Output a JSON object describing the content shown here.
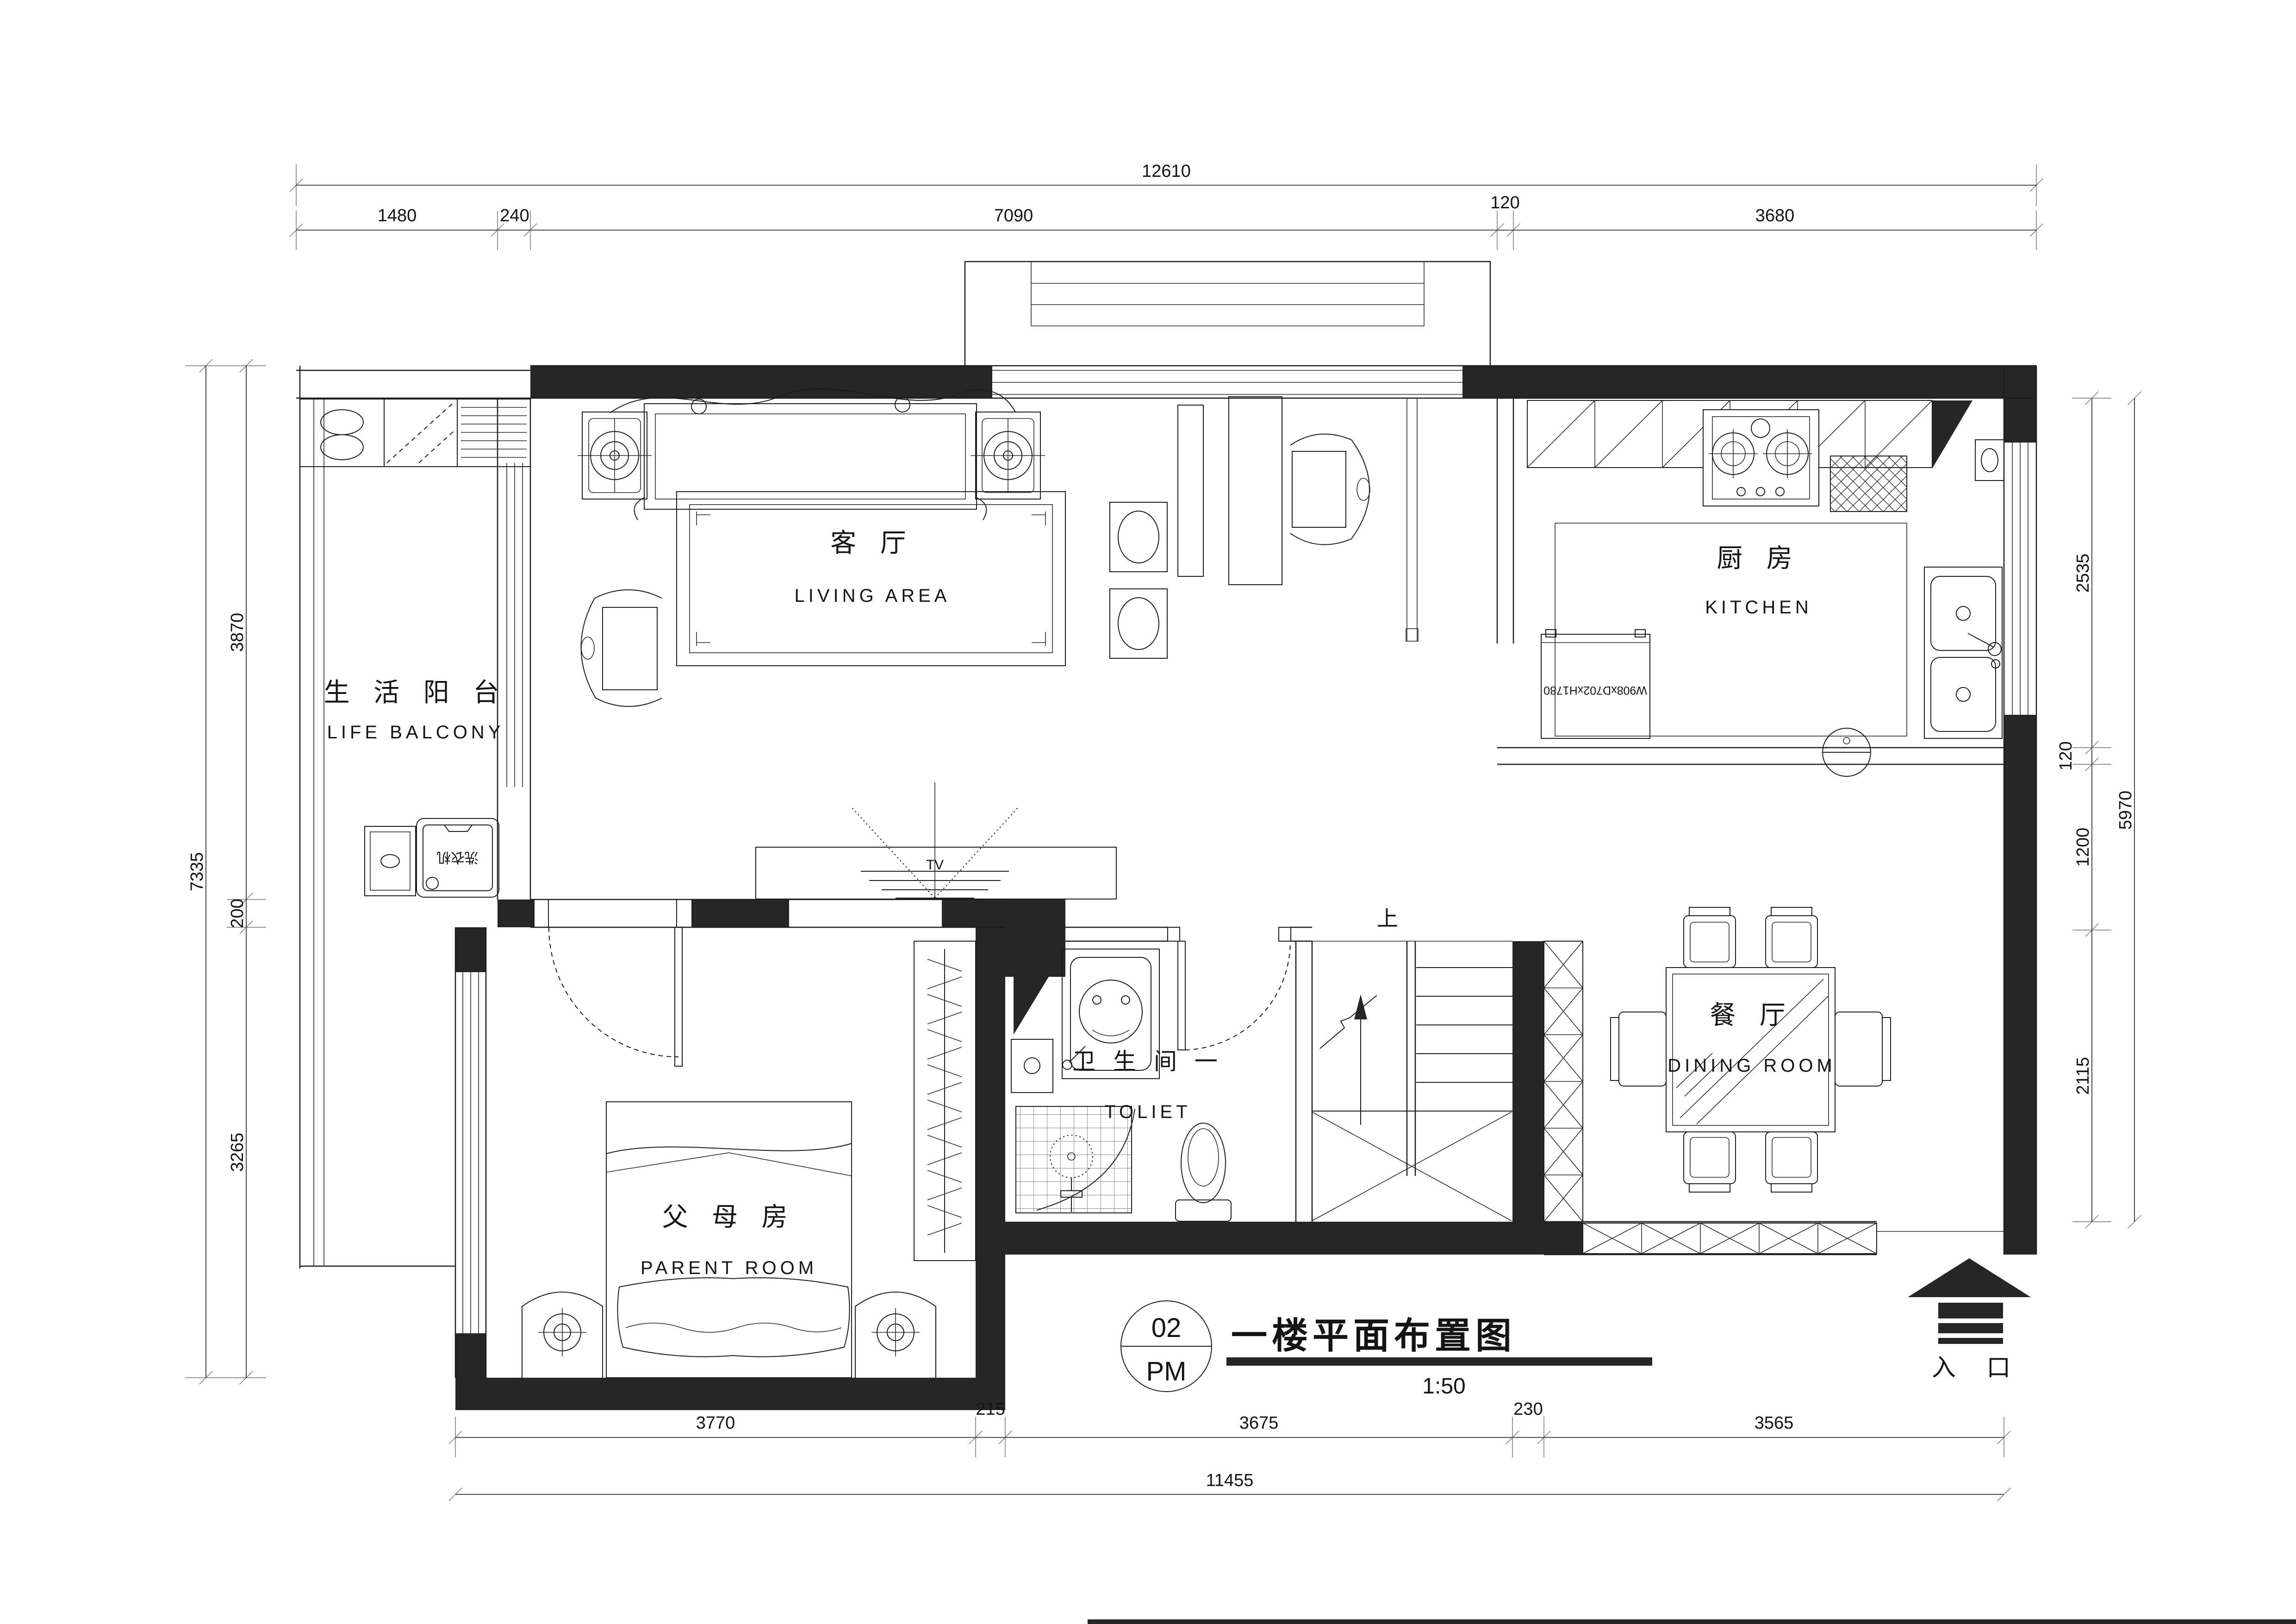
{
  "title_block": {
    "sheet_number": "02",
    "sheet_code": "PM",
    "title": "一楼平面布置图",
    "scale": "1:50"
  },
  "rooms": {
    "balcony": {
      "cn": "生 活 阳 台",
      "en": "LIFE BALCONY"
    },
    "living": {
      "cn": "客 厅",
      "en": "LIVING  AREA"
    },
    "kitchen": {
      "cn": "厨 房",
      "en": "KITCHEN"
    },
    "dining": {
      "cn": "餐 厅",
      "en": "DINING ROOM"
    },
    "toilet": {
      "cn": "卫 生 间 一",
      "en": "TOLIET"
    },
    "parent": {
      "cn": "父 母 房",
      "en": "PARENT ROOM"
    }
  },
  "annotations": {
    "tv": "TV",
    "stairs_up": "上",
    "entrance": "入 口",
    "washer": "洗衣机",
    "fridge_size": "W908xD702xH1780"
  },
  "dimensions": {
    "top": {
      "overall": "12610",
      "segments": [
        "1480",
        "240",
        "7090",
        "120",
        "3680"
      ]
    },
    "bottom": {
      "overall": "11455",
      "segments": [
        "3770",
        "215",
        "3675",
        "230",
        "3565"
      ]
    },
    "left": {
      "overall": "7335",
      "segments": [
        "3870",
        "200",
        "3265"
      ]
    },
    "right": {
      "overall": "5970",
      "segments": [
        "2535",
        "120",
        "1200",
        "2115"
      ]
    }
  },
  "colors": {
    "line": "#1c1c1c",
    "wall_fill": "#262626",
    "paper": "#ffffff"
  }
}
